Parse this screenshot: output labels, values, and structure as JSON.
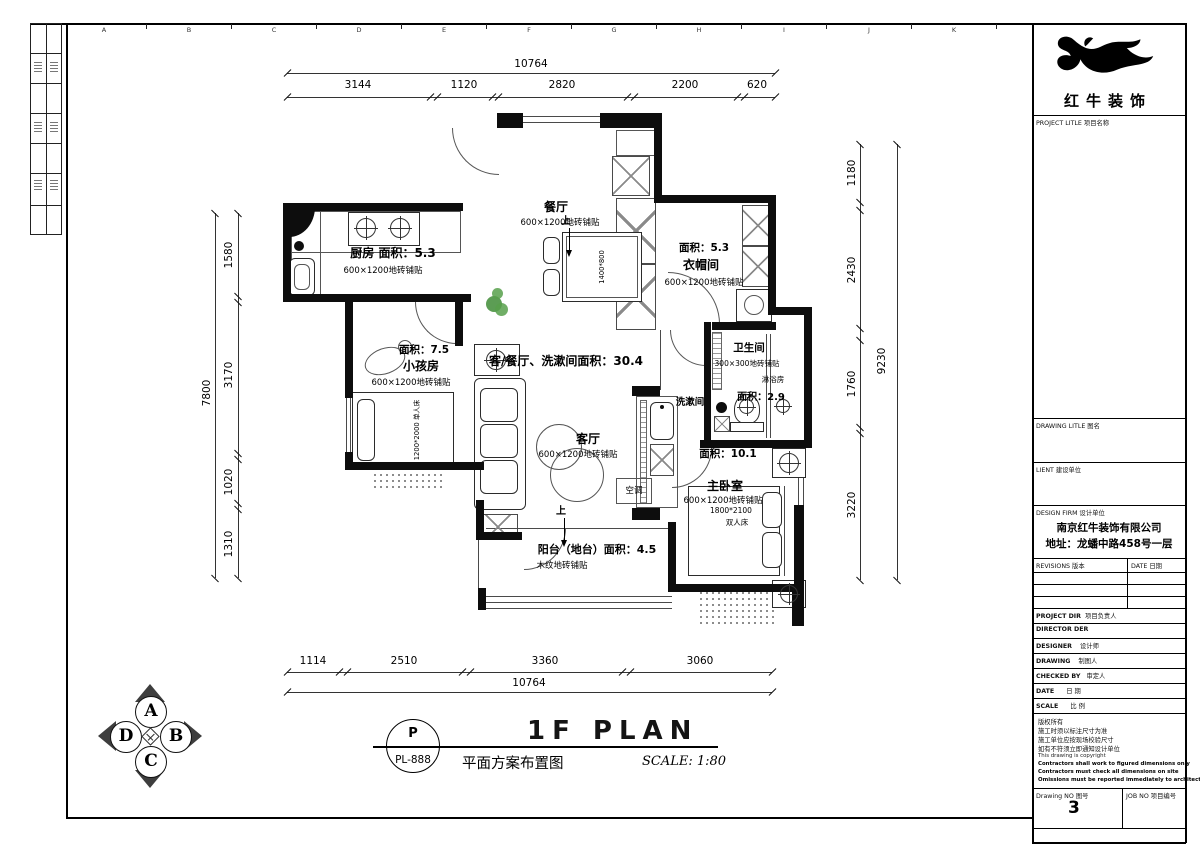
{
  "sheet": {
    "grid_letters_top": [
      "A",
      "B",
      "C",
      "D",
      "E",
      "F",
      "G",
      "H",
      "I",
      "J",
      "K"
    ]
  },
  "dims": {
    "top": {
      "total": "10764",
      "segments": [
        "3144",
        "1120",
        "2820",
        "2200",
        "620"
      ]
    },
    "bottom": {
      "total": "10764",
      "segments": [
        "1114",
        "2510",
        "3360",
        "3060"
      ]
    },
    "left": {
      "total": "7800",
      "segments": [
        "1580",
        "3170",
        "1020",
        "1310"
      ]
    },
    "right": {
      "total": "9230",
      "segments": [
        "1180",
        "2430",
        "1760",
        "3220"
      ]
    }
  },
  "plan": {
    "combined_area": "客/餐厅、洗漱间面积：30.4",
    "kitchen": {
      "title": "厨房 面积：5.3",
      "finish": "600×1200地砖铺贴"
    },
    "dining": {
      "title": "餐厅",
      "finish": "600×1200地砖铺贴",
      "table": "1400*800"
    },
    "cloakroom": {
      "area": "面积：5.3",
      "title": "衣帽间",
      "finish": "600×1200地砖铺贴"
    },
    "kids": {
      "area": "面积：7.5",
      "title": "小孩房",
      "finish": "600×1200地砖铺贴",
      "bed": "1200*2000 单人床"
    },
    "living": {
      "title": "客厅",
      "finish": "600×1200地砖铺贴"
    },
    "washroom": {
      "title": "洗漱间"
    },
    "bathroom": {
      "title": "卫生间",
      "finish": "300×300地砖铺贴",
      "shower": "淋浴房",
      "area": "面积：2.9"
    },
    "master": {
      "area": "面积：10.1",
      "title": "主卧室",
      "finish": "600×1200地砖铺贴",
      "bed_size": "1800*2100",
      "bed_type": "双人床"
    },
    "balcony": {
      "title": "阳台（地台）面积：4.5",
      "finish": "木纹地砖铺贴"
    },
    "ac": "空调",
    "up": "上"
  },
  "titlebar": {
    "bubble_top": "P",
    "bubble_code": "PL-888",
    "title_en": "1F PLAN",
    "title_cn": "平面方案布置图",
    "scale": "SCALE: 1:80"
  },
  "compass": {
    "top": "A",
    "right": "B",
    "bottom": "C",
    "left": "D"
  },
  "titleblock": {
    "logo_name": "红牛装饰",
    "project_label": "PROJECT LITLE 项目名称",
    "drawing_label": "DRAWING LITLE 图名",
    "client_label": "LIENT 建设单位",
    "firm_label": "DESIGN FIRM 设计单位",
    "firm_name": "南京红牛装饰有限公司",
    "firm_addr": "地址：龙蟠中路458号一层",
    "revisions_label": "REVISIONS 版本",
    "revisions_date_label": "DATE 日期",
    "rows": [
      {
        "en": "PROJECT DIR",
        "cn": "项目负责人"
      },
      {
        "en": "DIRECTOR DER",
        "cn": ""
      },
      {
        "en": "DESIGNER",
        "cn": "设计师"
      },
      {
        "en": "DRAWING",
        "cn": "制图人"
      },
      {
        "en": "CHECKED BY",
        "cn": "审定人"
      },
      {
        "en": "DATE",
        "cn": "日  期"
      },
      {
        "en": "SCALE",
        "cn": "比  例"
      }
    ],
    "notes_cn": [
      "版权所有",
      "施工时须以标注尺寸为准",
      "施工单位应按现场校验尺寸",
      "如有不符须立即通知设计单位"
    ],
    "notes_en": [
      "This drawing is copyright",
      "Contractors shall work to figured dimensions only",
      "Contractors must check all dimensions on site",
      "Omissions must be reported immediately to architects"
    ],
    "drawing_no_label": "Drawing NO 图号",
    "drawing_no": "3",
    "job_no_label": "JOB NO 项目编号"
  }
}
